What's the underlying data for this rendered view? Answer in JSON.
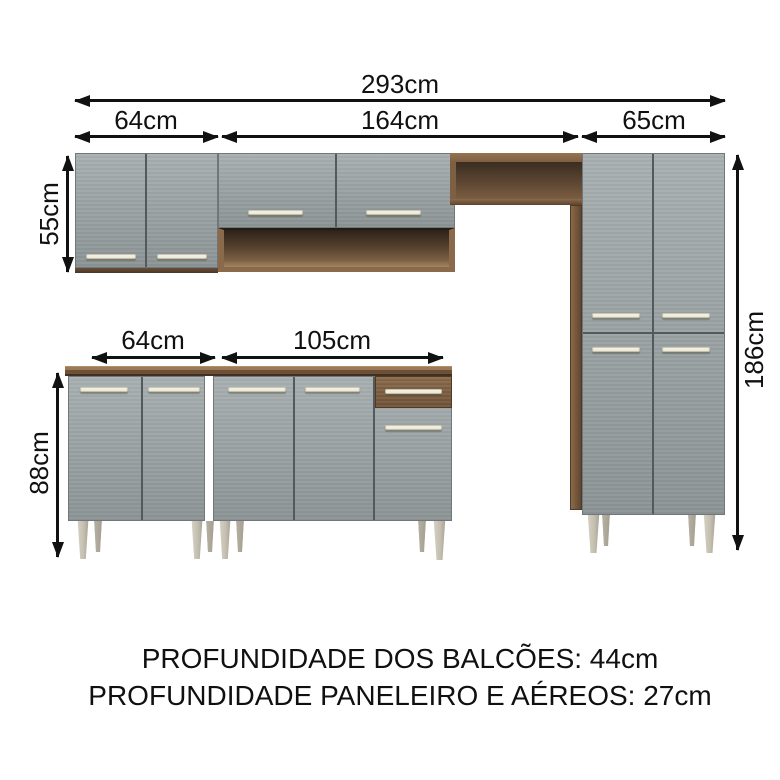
{
  "diagram": {
    "kind": "kitchen-cabinet-set-dimension-diagram",
    "dims": {
      "total_width": "293cm",
      "upper_left_width": "64cm",
      "upper_middle_width": "164cm",
      "upper_right_width": "65cm",
      "upper_cabinet_height": "55cm",
      "lower_left_width": "64cm",
      "lower_middle_width": "105cm",
      "lower_cabinet_height": "88cm",
      "tall_cabinet_height": "186cm"
    },
    "notes": {
      "line1": "PROFUNDIDADE DOS BALCÕES: 44cm",
      "line2": "PROFUNDIDADE PANELEIRO E AÉREOS: 27cm"
    },
    "colors": {
      "background": "#ffffff",
      "arrow_black": "#111111",
      "door_gray": "#9aa2a4",
      "wood_medium": "#8a6a4a",
      "countertop": "#6d5039",
      "handle_cream": "#e8e5d2",
      "leg_gray": "#c4bfb0"
    }
  }
}
